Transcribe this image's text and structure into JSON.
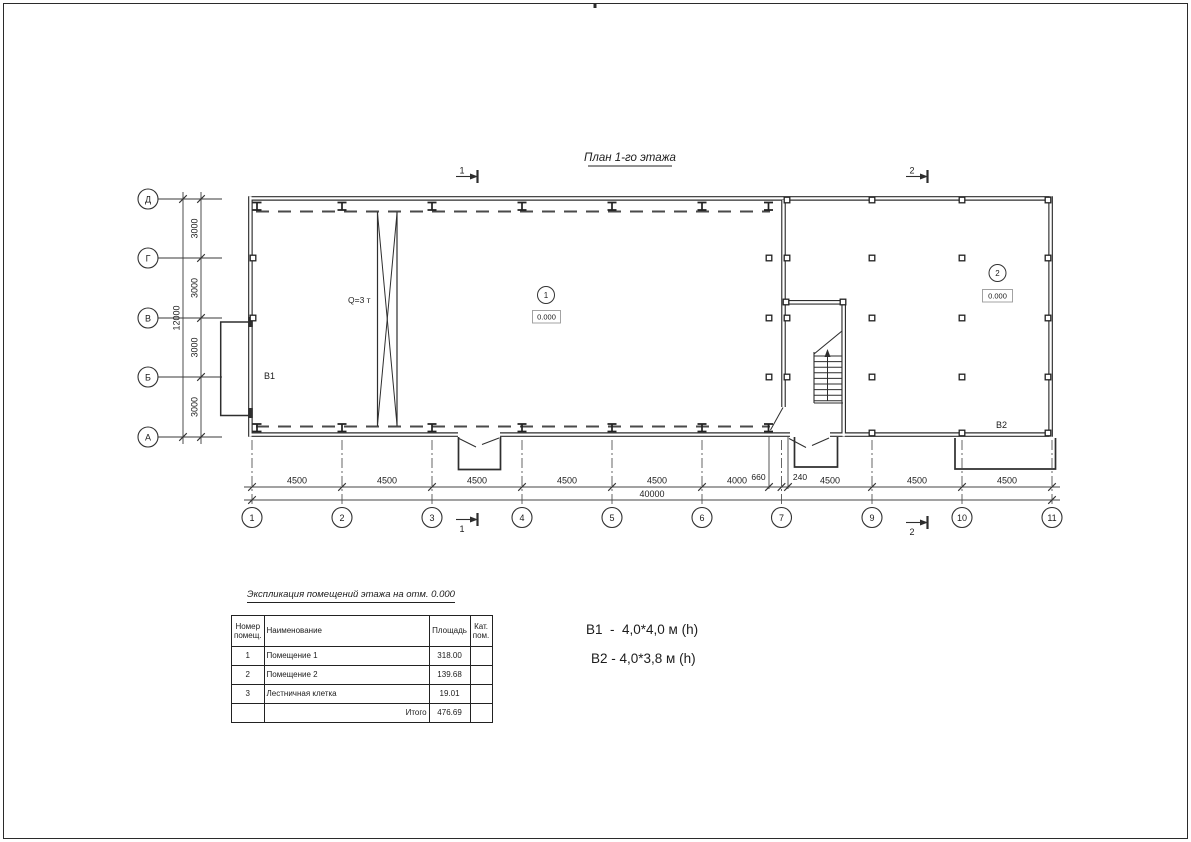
{
  "drawing": {
    "title": "План 1-го этажа",
    "crane_label": "Q=3 т",
    "room1": {
      "number": "1",
      "elevation": "0.000",
      "gate_label": "В1"
    },
    "room2": {
      "number": "2",
      "elevation": "0.000",
      "gate_label": "В2"
    },
    "sections": {
      "s1": "1",
      "s2": "2"
    },
    "axes": {
      "rows": [
        {
          "label": "Д"
        },
        {
          "label": "Г"
        },
        {
          "label": "В"
        },
        {
          "label": "Б"
        },
        {
          "label": "А"
        }
      ],
      "cols": [
        {
          "label": "1"
        },
        {
          "label": "2"
        },
        {
          "label": "3"
        },
        {
          "label": "4"
        },
        {
          "label": "5"
        },
        {
          "label": "6"
        },
        {
          "label": "7"
        },
        {
          "label": "9"
        },
        {
          "label": "10"
        },
        {
          "label": "11"
        }
      ]
    },
    "dims": {
      "vertical_segments": [
        "3000",
        "3000",
        "3000",
        "3000"
      ],
      "vertical_total": "12000",
      "bottom_segments": [
        "4500",
        "4500",
        "4500",
        "4500",
        "4500",
        "4000",
        "660",
        "240",
        "4500",
        "4500",
        "4500"
      ],
      "bottom_total": "40000"
    }
  },
  "table": {
    "title": "Экспликация помещений этажа на отм. 0.000",
    "headers": [
      "Номер помещ.",
      "Наименование",
      "Площадь",
      "Кат. пом."
    ],
    "rows": [
      [
        "1",
        "Помещение 1",
        "318.00",
        ""
      ],
      [
        "2",
        "Помещение 2",
        "139.68",
        ""
      ],
      [
        "3",
        "Лестничная клетка",
        "19.01",
        ""
      ]
    ],
    "total_label": "Итого",
    "total_value": "476.69"
  },
  "notes": {
    "line1": "В1  -  4,0*4,0 м (h)",
    "line2": "В2 - 4,0*3,8 м (h)"
  }
}
